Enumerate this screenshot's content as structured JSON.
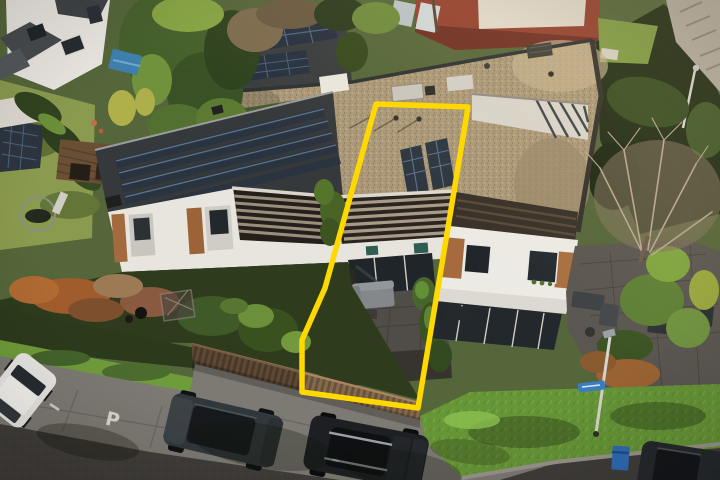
{
  "meta": {
    "description": "Aerial drone photo of a row of terraced houses; the middle house and its plot are outlined in yellow",
    "canvas": {
      "width": 720,
      "height": 480
    }
  },
  "highlight": {
    "label": "highlighted-plot",
    "color": "#ffd800",
    "stroke_width": 5.5,
    "points": "376,104 468,107 418,408 302,392 302,340 325,288"
  },
  "road": {
    "parking_marking": "P",
    "surface_color": "#403d3a",
    "parking_lane_color": "#7d7973",
    "marking_color": "#d9d6cc"
  },
  "palette": {
    "gravel_roof": "#ab9878",
    "dark_roof": "#36393b",
    "solar_panel": "#273140",
    "solar_line": "#51677e",
    "facade_white": "#e8e5de",
    "wood_cladding": "#a26a3e",
    "pergola_wood": "#9a8d7c",
    "hedge_green": "#3f5a28",
    "grass_bank": "#679637",
    "lawn": "#8a9a4e",
    "fence_wood": "#75593f",
    "patio_gray": "#504c47",
    "glass_dark": "#20252a",
    "brick_red": "#93402f",
    "pool_blue": "#3f7fae",
    "sign_blue": "#3b7ec2",
    "bin_blue": "#2f6cb5",
    "car_white": "#e8e7e3",
    "car_dark": "#31383c",
    "car_black": "#1d1f22",
    "sofa_gray": "#85888b"
  },
  "scene": {
    "buildings": [
      "detached house top-left",
      "back terrace row with gravel flat roof",
      "front terrace row with solar panel roof",
      "highlighted middle house with two solar panels",
      "right end house with white facade",
      "red brick building in background"
    ],
    "vehicles": [
      "white hatchback parked left",
      "dark grey estate car",
      "black estate car with roof bars",
      "dark car bottom right corner"
    ],
    "street_objects": [
      "lamp post",
      "blue street name sign",
      "blue wheelie bin",
      "wooden garden fence",
      "parking P road marking"
    ]
  }
}
